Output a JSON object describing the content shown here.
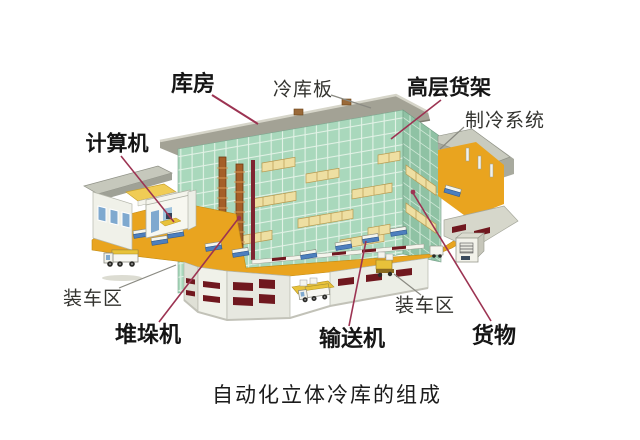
{
  "caption": "自动化立体冷库的组成",
  "labels": {
    "warehouse": "库房",
    "cold_storage_panel": "冷库板",
    "high_rise_rack": "高层货架",
    "refrigeration_system": "制冷系统",
    "computer": "计算机",
    "loading_area_left": "装车区",
    "stacker_crane": "堆垛机",
    "conveyor": "输送机",
    "loading_area_right": "装车区",
    "goods": "货物"
  },
  "colors": {
    "leader_red": "#9c3352",
    "leader_gray": "#8a8a82",
    "rack_green_front": "#a9d8bc",
    "rack_green_side": "#8fc2a4",
    "roof_gray": "#a3a295",
    "floor_orange": "#e9a41f",
    "wall_white": "#eceee6",
    "dock_door_red": "#70181f",
    "goods_yellow": "#eedfa2",
    "conveyor_blue": "#4d7fbe",
    "crane_brown": "#a55f28",
    "window_blue": "#7fa9cf",
    "desk_yellow": "#f0c94a"
  }
}
